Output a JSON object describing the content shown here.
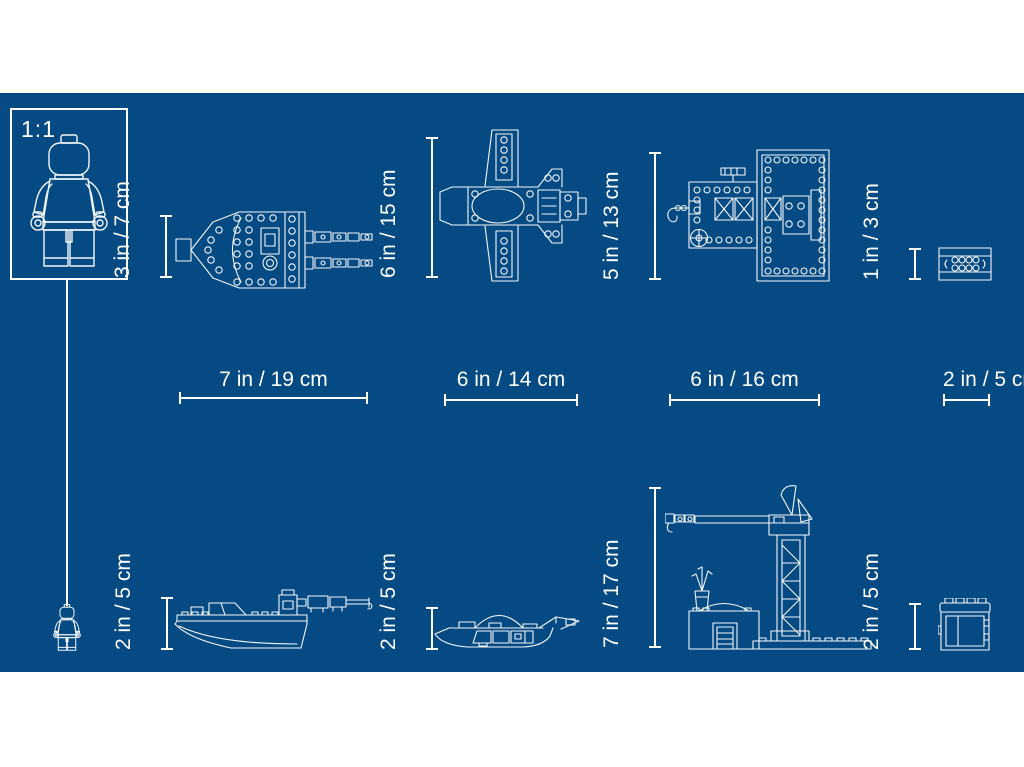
{
  "theme": {
    "background_color": "#064A83",
    "line_color": "#FFFFFF"
  },
  "scale_box": {
    "label": "1:1"
  },
  "dimensions": {
    "boat_top": {
      "height": "3 in / 7 cm",
      "width": "7 in / 19 cm"
    },
    "plane_top": {
      "height": "6 in / 15 cm",
      "width": "6 in / 14 cm"
    },
    "platform_top": {
      "height": "5 in / 13 cm",
      "width": "6 in / 16 cm"
    },
    "plate_top": {
      "height": "1 in / 3 cm",
      "width": "2 in / 5 cm"
    },
    "boat_side": {
      "height": "2 in / 5 cm"
    },
    "submarine_side": {
      "height": "2 in / 5 cm"
    },
    "crane_side": {
      "height": "7 in / 17 cm"
    },
    "container_side": {
      "height": "2 in / 5 cm"
    }
  }
}
